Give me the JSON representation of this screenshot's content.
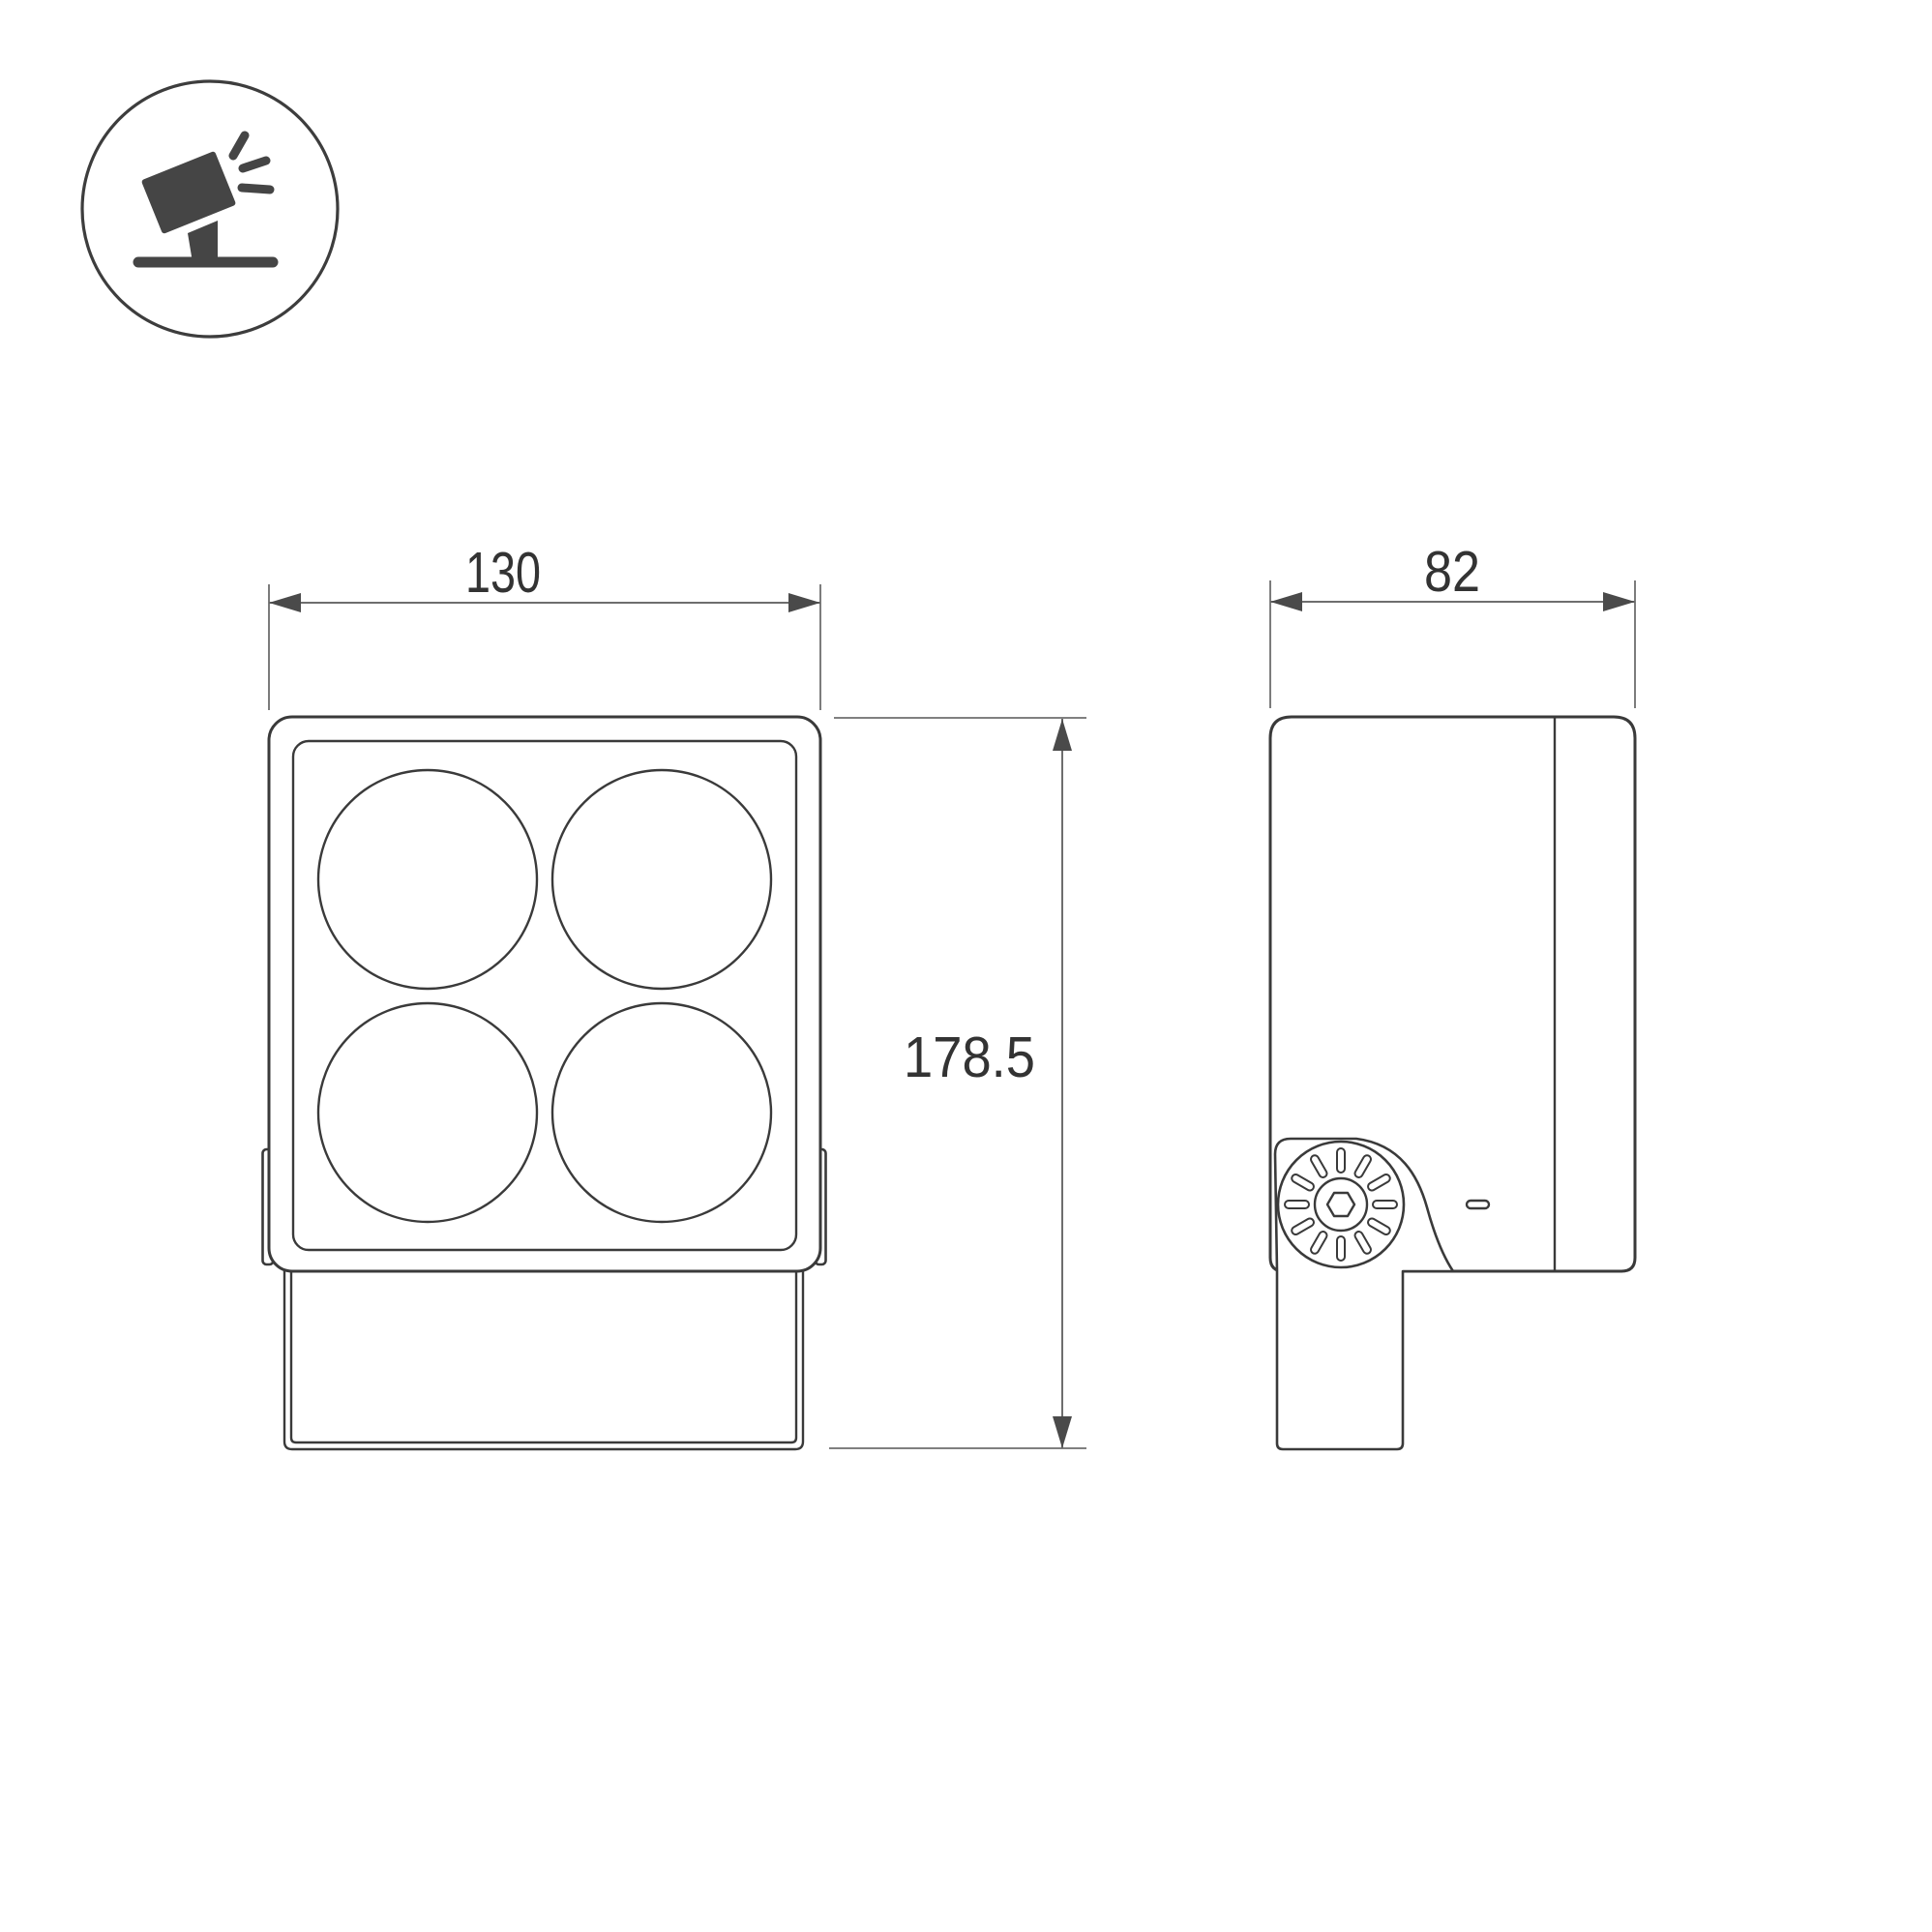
{
  "drawing": {
    "type": "product-dimension-drawing",
    "subject": "square four-lens floodlight with pivot bracket, front and side orthographic views",
    "icon": {
      "name": "tilting-floodlight-on-stand-icon"
    },
    "dimensions": {
      "width": {
        "value": "130"
      },
      "depth": {
        "value": "82"
      },
      "height": {
        "value": "178.5"
      }
    },
    "colors": {
      "background": "#ffffff",
      "outline": "#3a3a3a",
      "dimension_line": "#6e6e6e",
      "arrowhead": "#4a4a4a",
      "text": "#333333",
      "icon": "#454545"
    }
  }
}
